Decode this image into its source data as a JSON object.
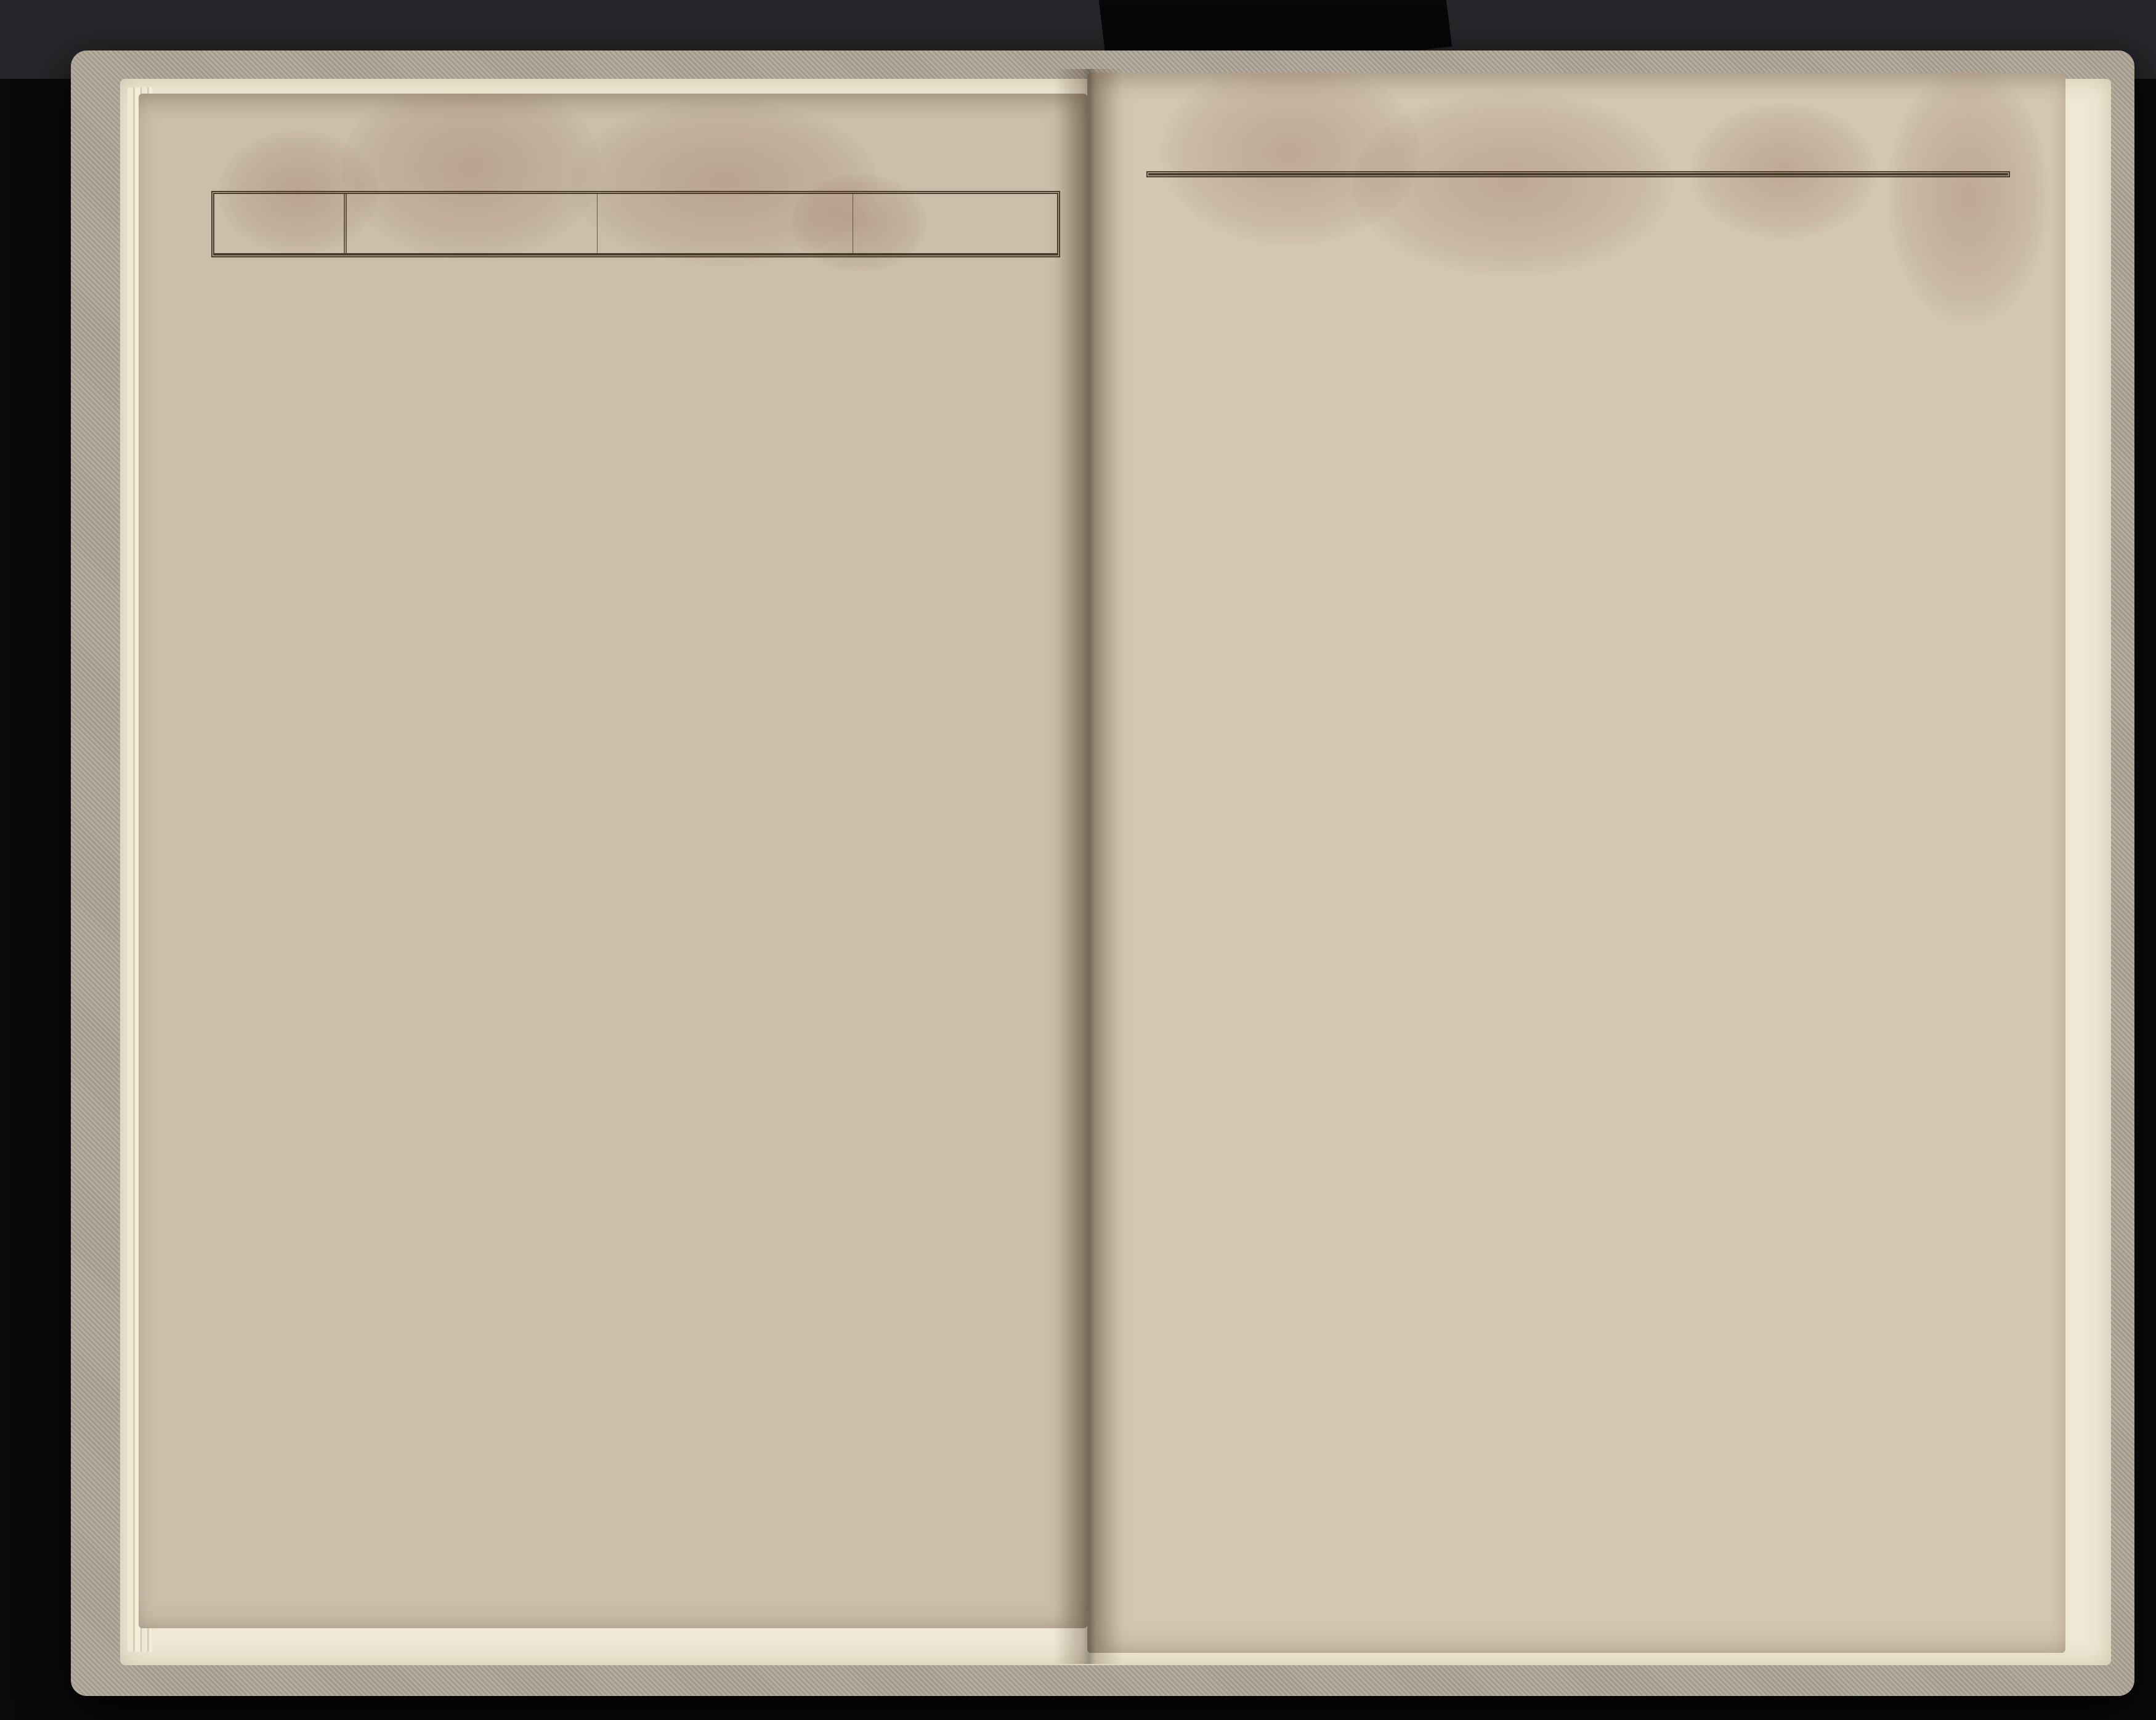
{
  "scene": {
    "background_color": "#0a0a0c",
    "cover_color": "#b0a899",
    "underpaper_color": "#efe8d4",
    "page_color_left": "#cbbfab",
    "page_color_right": "#d3c7b3",
    "ink_color": "#3f3227",
    "hand_ink_color": "#5c452e",
    "side_mark": ")"
  },
  "header_labels": {
    "sponsus": "Sponſus",
    "sponsa": "Sponſa",
    "testes": "Teſtes",
    "mensis": "Menſis",
    "nrus": [
      "Nrus",
      "Do-",
      "mus"
    ],
    "nomen": "NOMEN",
    "conditio": "CONDITIO",
    "religio": "Religio",
    "catholica": "Catholica",
    "aut_alia": "Aut alia",
    "aetas": "Ætas",
    "caelebs": "Cælebs",
    "viduus": "Viduus",
    "vidua": "Vidua"
  },
  "pages": [
    {
      "pag": "Pag 32",
      "corner_struck": "178",
      "corner_year": "1839",
      "rows": [
        {
          "type": "note",
          "underline": true,
          "lines": [
            "Menses Martius - Aprilis et Majus",
            "1839ni Anni Vacant."
          ]
        },
        {
          "type": "note",
          "underline": true,
          "lines": [
            "Menses Junius. Julius. Augustus. 7ber et",
            "8ber 1839ni Anni Vacant."
          ]
        },
        {
          "type": "entry",
          "mensis": "die 10: gbris 1839",
          "nrus": [
            "61.",
            "24"
          ],
          "sponsus": "Josephus filius Adalberti ac Mag: dalenna Kelbow Agricolar",
          "sp_c": "i.",
          "sp_ae": "23",
          "sp_st": "c.",
          "sponsa": "Catharina filia Ca: simiri ac Agne: tis Sesz: narow Agricolar",
          "sa_c": "i.",
          "sa_ae": "22",
          "sa_st": "c.",
          "testes": [
            "Mathias Popławski †",
            "Johannes Stangret †"
          ],
          "conditio": "Agricola",
          "notes": [
            "Consensus Nubendi ex Parte Dominii Touste",
            "ddo 12. 8bris 1839ni Anni No 853 in Actis repert",
            "Benedixit Ignatius"
          ]
        },
        {
          "type": "entry",
          "mensis": "die 17a gbris 1839",
          "nrus": [
            "14",
            "66"
          ],
          "sponsus": "Laurentius filius An: drea et Maria Dziuda Rusticus",
          "sp_c": "i.",
          "sp_ae": "26",
          "sp_st": "c.",
          "sponsa": "Maria filia Ba: silii ac Maria Stohryny Rusticer",
          "sa_c": "i.",
          "sa_ae": "20",
          "sa_st": "c.",
          "testes": [
            "Mathias Sobkow †",
            "Andreas Furman †"
          ],
          "conditio": "Rustici",
          "notes": [
            "Consensus Nubendi ex Parte Dominii Touste",
            "ddo 6. gbris 1839ni Anni No 991 in Actis",
            "Matrimonialibus reperitur",
            "Benedixit Antonius Brodowicz Curatus."
          ]
        },
        {
          "type": "note",
          "underline": true,
          "lines": [
            "Mensis Xber 1839ni Anni Vacat."
          ]
        },
        {
          "type": "heading",
          "text": "Annus Domini 1840mus"
        },
        {
          "type": "entry",
          "mensis": "Die 23a Februar. 1840.",
          "nrus": [
            "94",
            "51."
          ],
          "sponsus": "Michael filius Jo: sephi et Anastasia Czernia: wski subditorum",
          "sp_c": "i.",
          "sp_ae": "46.",
          "sp_st": "i.",
          "sponsa": "Sophia 1voto Bła: szkowa fi: lia Bartho: lomei et Anna Try: makow subditorum",
          "sa_c": "i.",
          "sa_ae": "25.",
          "sa_st": "i.",
          "testes": [
            "Gasparus Mazur †",
            "Mathias Samborski †"
          ],
          "conditio": "Rustici.",
          "notes": [
            "Consensus Nubendi ex Parte Dominii Touste ddo 5 febr 840",
            "No 103 reperitur in Actis Matrimonialibus.",
            "Ratificavit Matrimonium Ignatius Seidl Coop."
          ]
        }
      ]
    },
    {
      "pag": "Pag 33",
      "corner_struck": "178",
      "corner_year": "1840.",
      "rows": [
        {
          "type": "entry",
          "mensis": "15a Aug 1840.",
          "nrus": [
            "62",
            "59."
          ],
          "sponsus": "Antonius filius Mi: chaelis ac Agnetis Kelbow a: gricolarum",
          "sp_c": "i.",
          "sp_ae": "69.",
          "sp_st": "i",
          "sponsa": "Maria 1o voto Popław: ska filia Jo: sephi ac Sophia Czernieckich Agricolar",
          "sa_c": "i.",
          "sa_ae": "26.",
          "sa_st": "i.",
          "testes": [
            "Joannes Szymanski †",
            "Joannes Stangret †"
          ],
          "conditio": "Agricolæ.",
          "notes": [
            "Ratificavit Ant."
          ]
        },
        {
          "type": "entry",
          "mensis": "15a 9br 1840.",
          "nrus": [
            "91",
            "11."
          ],
          "sponsus": "Andreas fi: lius Lucæ ac Rosalia Jastrzebski Agricolar.",
          "sp_c": "i.",
          "sp_ae": "27.",
          "sp_st": "i.",
          "sponsa": "Rosalia filia Casi: miri ac Eva Dziu: dow Agri: colarum",
          "sa_c": "i.",
          "sa_ae": "18.",
          "sa_st": "i.",
          "testes": [
            "Jacobus Dziuda. †",
            "Michael Gorbalski †"
          ],
          "conditio": "Agricolæ",
          "notes": [
            "Cons. nubend. ex parte Dom. Touste N 1230 ds 29a 8br",
            "840 in Actis Matrim. reperit.",
            "Benedixit."
          ]
        },
        {
          "type": "entry",
          "mensis": "15a 9br 1840.",
          "nrus": [
            "13",
            "1."
          ],
          "sponsus": "Theodorus filius Theo: dori ac Ma: ria Szewczyk Agricolar Gr. g. c.",
          "sp_c": "i.",
          "sp_ae": "21.",
          "sp_st": "i.",
          "sponsa": "Rosalia fi: lia Simeo: nis ac Fran: cisca Szew: czuk.",
          "sa_c": "i.",
          "sa_ae": "19.",
          "sa_st": "i.",
          "testes": [
            "Alexander Wozny †",
            "Adalbertus Kelba."
          ],
          "conditio": "Agricola",
          "notes": [
            "Cons. nubendi ex parte Dom. Touste No 1165 ds 17a 8b",
            "840 in Actis Matrim. reperitz.",
            "Benedixit."
          ]
        },
        {
          "type": "heading",
          "text": "Annus Domini 1841."
        },
        {
          "type": "entry",
          "mensis": "14a febr 1841.",
          "nrus": [
            "11",
            "74."
          ],
          "sponsus": "Alexander Humeniuk viduus fili Joannis ac Eudoxia Agricolar",
          "sp_c": "i.",
          "sp_ae": "40",
          "sp_st": "i.",
          "sponsa": "Catharina 1voto Fedczyszyn filia Jacobi ac Maria Dziuda Agricolar",
          "sa_c": "i.",
          "sa_ae": "38.",
          "sa_st": "i.",
          "testes": [
            "Michael Gordalski †",
            "Thomas Dziuda †"
          ],
          "conditio": "Agricolæ",
          "notes": [
            "Ratificavit Ignatius Seidl Coop."
          ]
        },
        {
          "type": "heading",
          "text": "Annus Domini 1842."
        },
        {
          "type": "entry",
          "mensis": "30a Octobris 1842.",
          "nrus": [
            "28",
            "18."
          ],
          "sponsus": "Lucas filius Stephani ac Xenia Sowiecki Agricolarz bezago Nowosiołka",
          "sp_c": "i.",
          "sp_ae": "33.",
          "sp_st": "i.",
          "sponsa": "Maria filia Mar: tini ac Maria Jęczmie: nosti Agricolarz",
          "sa_c": "i.",
          "sa_ae": "20.",
          "sa_st": "i.",
          "testes": [
            "Theodorus Lusznyj †",
            "Basilius Potoz †"
          ],
          "conditio": "Agricolæ",
          "notes": [
            "Cons. nubendi ex parte Dominii Grzymałow",
            "ddo 24a 8b 842 N 1171 in actis Matrim. reperitz.",
            "Benedixit Ignatius Seidel Coop."
          ]
        },
        {
          "type": "entry",
          "mensis": "13a gbr 1842",
          "nrus": [
            "51",
            "35."
          ],
          "sponsus": "Michael filius Ma: thiæ ac Sophia Błaszkow Agricolarz",
          "sp_c": "i.",
          "sp_ae": "22.",
          "sp_st": "i.",
          "sponsa": "Victoria filia Si: meonis ac Catha: rina Kelba Agricola: rum",
          "sa_c": "i.",
          "sa_ae": "22.",
          "sa_st": "i.",
          "testes": [
            "Michael Gortalski †",
            "Basilius Potoz †"
          ],
          "conditio": "Agricolæ.",
          "notes": [
            "Consens nubendi ex parte Dom. Touste ds 12a 8b 842 N 1094 in Actis Matrim.",
            "Benedixit Wm. Antoni Brodowicz Curatus."
          ]
        }
      ]
    }
  ]
}
